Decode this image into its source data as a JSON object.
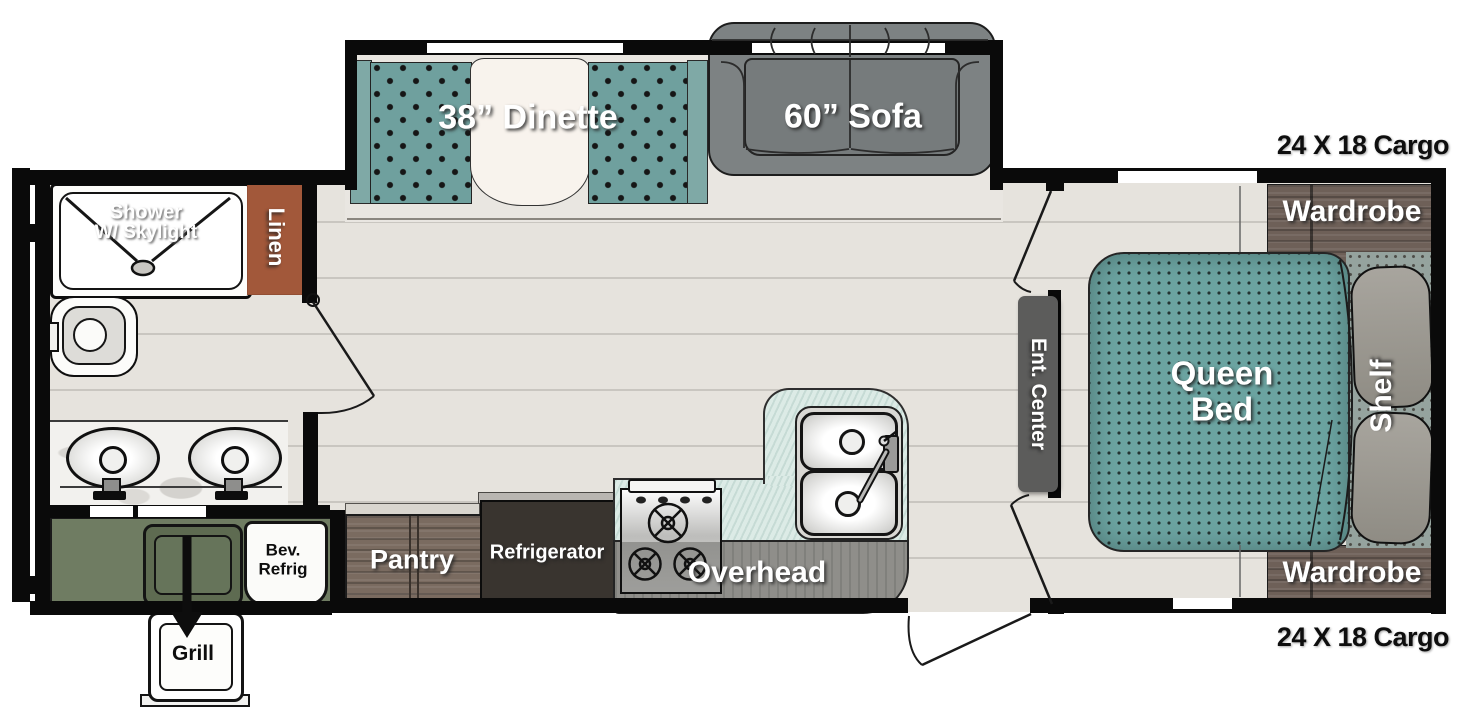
{
  "title": "Travel trailer floor plan",
  "labels": {
    "dinette": "38” Dinette",
    "sofa": "60” Sofa",
    "cargo_top": "24 X 18 Cargo",
    "cargo_bottom": "24 X 18 Cargo",
    "wardrobe_top": "Wardrobe",
    "wardrobe_bottom": "Wardrobe",
    "queen_bed": "Queen Bed",
    "shelf": "Shelf",
    "ent_center": "Ent. Center",
    "shower": "Shower",
    "shower_sub": "W/ Skylight",
    "linen": "Linen",
    "pantry": "Pantry",
    "refrigerator": "Refrigerator",
    "overhead": "Overhead",
    "bev_refrig": "Bev. Refrig",
    "grill": "Grill"
  },
  "colors": {
    "wall": "#0a0a0a",
    "floor": "#e6e3dd",
    "plank_line": "#c9c6c0",
    "upholstery_teal": "#6fa09e",
    "bed_teal": "#6ba3a0",
    "sofa_gray": "#7d8283",
    "wood_brown": "#6e6058",
    "linen_rust": "#a2583a",
    "counter_mint": "#dcebe6",
    "cabinet_gray": "#8f8e8a",
    "outdoor_olive": "#6f7c62",
    "fridge_dark": "#39342f"
  }
}
